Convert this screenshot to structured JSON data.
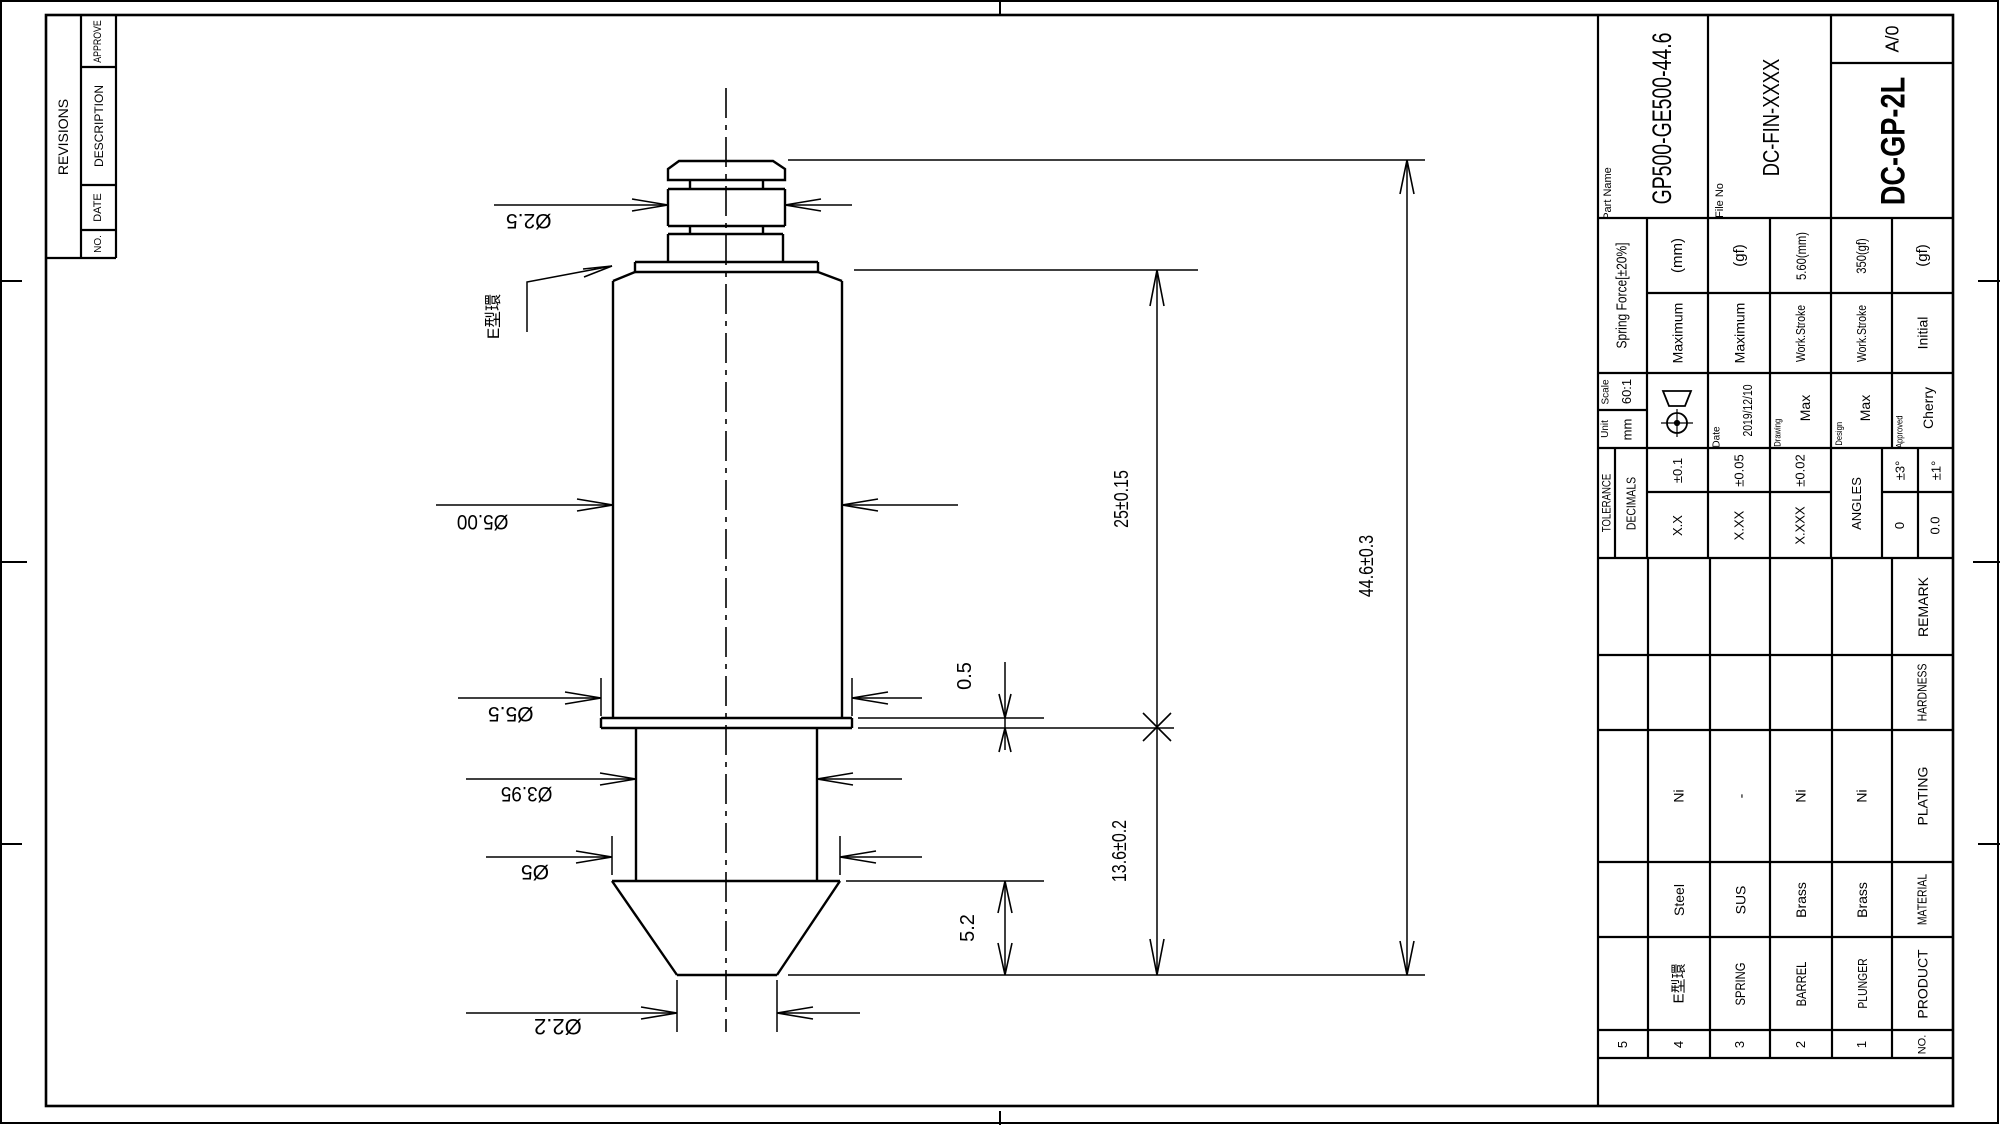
{
  "colors": {
    "line": "#000000",
    "background": "#ffffff"
  },
  "revisions": {
    "title": "REVISIONS",
    "no": "NO.",
    "date": "DATE",
    "description": "DESCRIPTION",
    "approve": "APPROVE"
  },
  "title_block": {
    "part_name_label": "Part Name",
    "part_name": "GP500-GE500-44.6",
    "file_no_label": "File No",
    "file_no": "DC-FIN-XXXX",
    "revision": "A/0",
    "product_code": "DC-GP-2L",
    "spring_force_title": "Spring Force[±20%]",
    "spec_rows": [
      {
        "value": "(mm)",
        "label": "Maximum"
      },
      {
        "value": "(gf)",
        "label": "Maximum"
      },
      {
        "value": "5.60(mm)",
        "label": "Work.Stroke"
      },
      {
        "value": "350(gf)",
        "label": "Work.Stroke"
      },
      {
        "value": "(gf)",
        "label": "Initial"
      }
    ],
    "scale_label": "Scale",
    "scale": "60:1",
    "unit_label": "Unit",
    "unit": "mm",
    "date_label": "Date",
    "date": "2019/12/10",
    "drawing_label": "Drawing",
    "drawing_by": "Max",
    "design_label": "Design",
    "design_by": "Max",
    "approved_label": "Approved",
    "approved_by": "Cherry",
    "tolerance_title": "TOLERANCE",
    "decimals_title": "DECIMALS",
    "decimal_rows": [
      {
        "label": "X.X",
        "value": "±0.1"
      },
      {
        "label": "X.XX",
        "value": "±0.05"
      },
      {
        "label": "X.XXX",
        "value": "±0.02"
      }
    ],
    "angles_title": "ANGLES",
    "angle_rows": [
      {
        "label": "0",
        "value": "±3°"
      },
      {
        "label": "0.0",
        "value": "±1°"
      }
    ]
  },
  "parts_table": {
    "headers": {
      "no": "NO.",
      "product": "PRODUCT",
      "material": "MATERIAL",
      "plating": "PLATING",
      "hardness": "HARDNESS",
      "remark": "REMARK"
    },
    "rows": [
      {
        "no": "5",
        "product": "",
        "material": "",
        "plating": ""
      },
      {
        "no": "4",
        "product": "E型環",
        "material": "Steel",
        "plating": "Ni"
      },
      {
        "no": "3",
        "product": "SPRING",
        "material": "SUS",
        "plating": "-"
      },
      {
        "no": "2",
        "product": "BARREL",
        "material": "Brass",
        "plating": "Ni"
      },
      {
        "no": "1",
        "product": "PLUNGER",
        "material": "Brass",
        "plating": "Ni"
      }
    ]
  },
  "dimensions": {
    "dia_plunger_top": "Ø2.5",
    "dia_barrel": "Ø5.00",
    "dia_flange": "Ø5.5",
    "dia_lower_barrel": "Ø3.95",
    "dia_cone": "Ø5",
    "dia_tip": "Ø2.2",
    "barrel_length": "25±0.15",
    "flange_thickness": "0.5",
    "lower_length": "13.6±0.2",
    "cone_length": "5.2",
    "total_length": "44.6±0.3",
    "ering_callout": "E型環"
  }
}
